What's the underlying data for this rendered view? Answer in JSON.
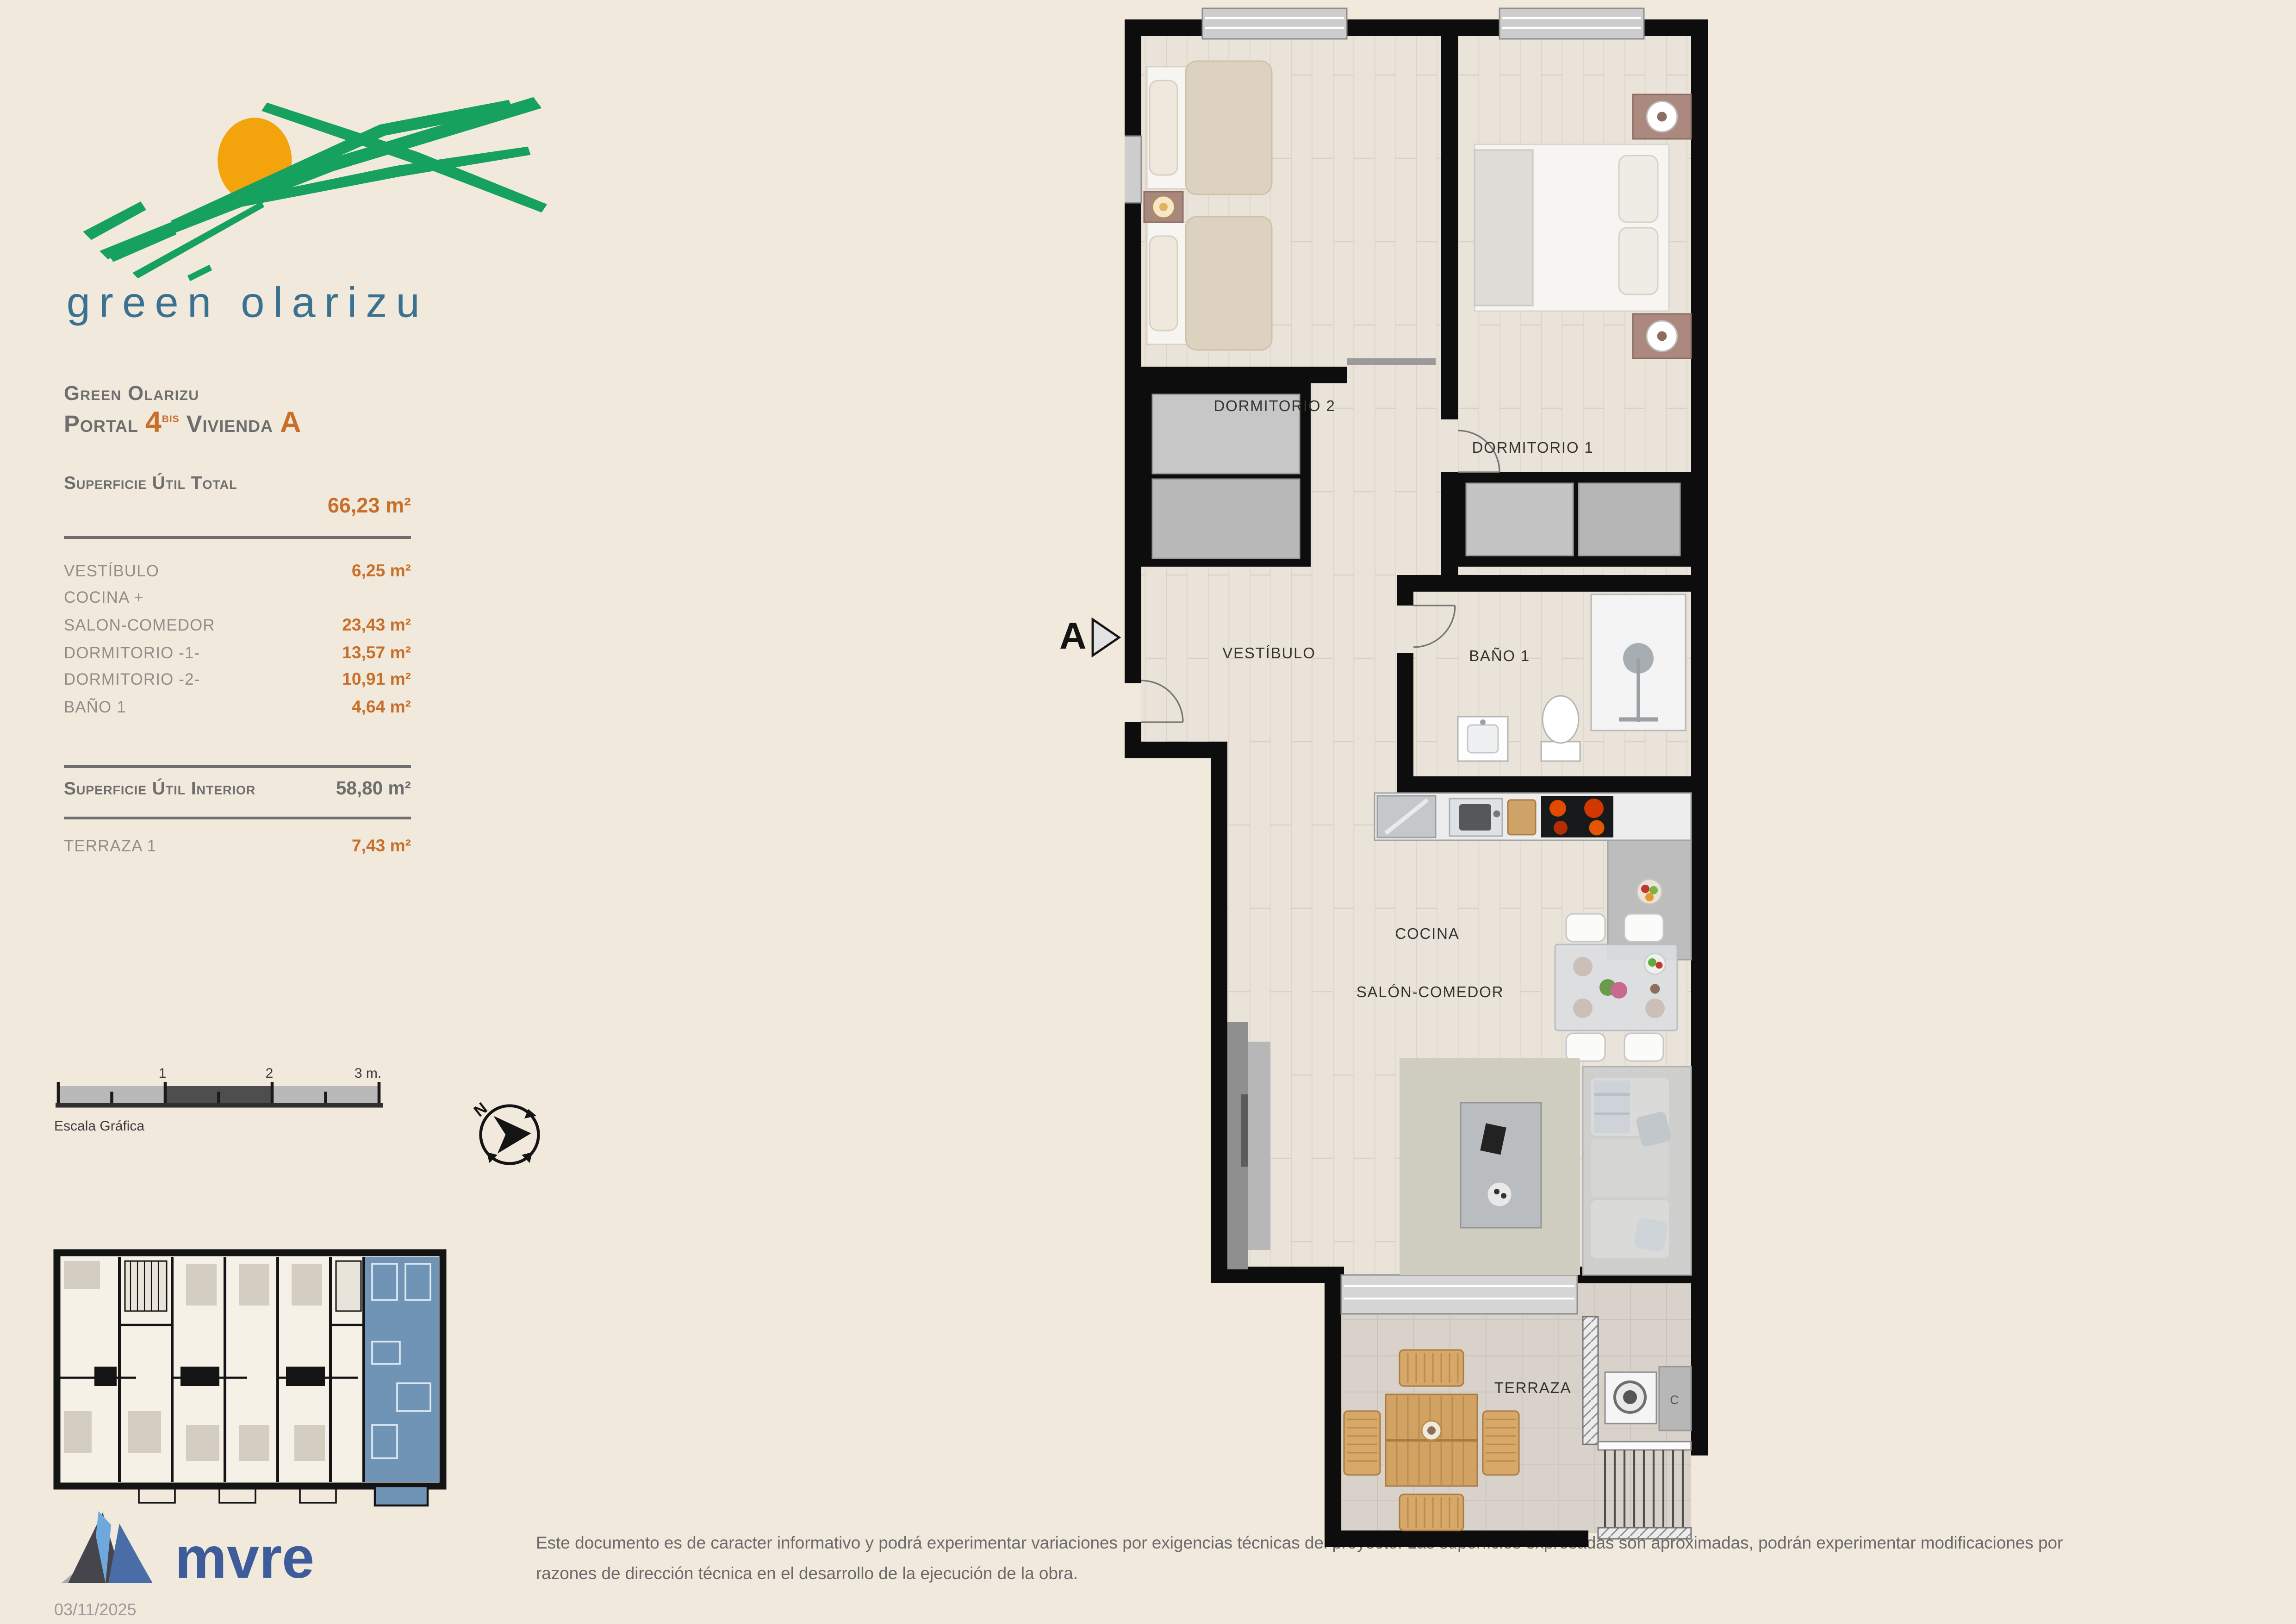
{
  "page": {
    "bg": "#f1e9dc"
  },
  "brand": {
    "logo_text": "green olarizu"
  },
  "header": {
    "project": "Green Olarizu",
    "portal_label": "Portal",
    "portal_number": "4",
    "portal_suffix": "bis",
    "dwelling_label": "Vivienda",
    "dwelling_letter": "A"
  },
  "surfaces": {
    "total_label": "Superficie Útil Total",
    "total_value": "66,23 m²",
    "rooms": [
      {
        "label": "VESTÍBULO",
        "value": "6,25 m²"
      },
      {
        "label": "COCINA +",
        "value": ""
      },
      {
        "label": "SALON-COMEDOR",
        "value": "23,43 m²"
      },
      {
        "label": "DORMITORIO -1-",
        "value": "13,57 m²"
      },
      {
        "label": "DORMITORIO -2-",
        "value": "10,91 m²"
      },
      {
        "label": "BAÑO 1",
        "value": "4,64 m²"
      }
    ],
    "interior_label": "Superficie Útil Interior",
    "interior_value": "58,80 m²",
    "terrace_label": "TERRAZA 1",
    "terrace_value": "7,43 m²"
  },
  "scale_bar": {
    "tick_1": "1",
    "tick_2": "2",
    "tick_3": "3 m.",
    "caption": "Escala Gráfica"
  },
  "compass": {
    "north": "N"
  },
  "plan": {
    "section_marker": "A",
    "labels": {
      "dorm2": "DORMITORIO 2",
      "dorm1": "DORMITORIO 1",
      "vestibulo": "VESTÍBULO",
      "bano": "BAÑO 1",
      "cocina": "COCINA",
      "salon": "SALÓN-COMEDOR",
      "terraza": "TERRAZA",
      "boiler": "C"
    }
  },
  "footer": {
    "logo_text": "mvre",
    "date": "03/11/2025",
    "disclaimer_line1": "Este documento es de caracter informativo y podrá experimentar variaciones por exigencias técnicas del proyecto. Las superficies expresadas son aproximadas, podrán experimentar modificaciones por",
    "disclaimer_line2": "razones de dirección técnica en el desarrollo de la ejecución de la obra."
  },
  "colors": {
    "accent_orange": "#c8702b",
    "text_gray": "#6e6e6e",
    "unit_highlight_blue": "#6f94b5",
    "logo_green": "#16a15f",
    "mvre_blue": "#3e5c99"
  }
}
